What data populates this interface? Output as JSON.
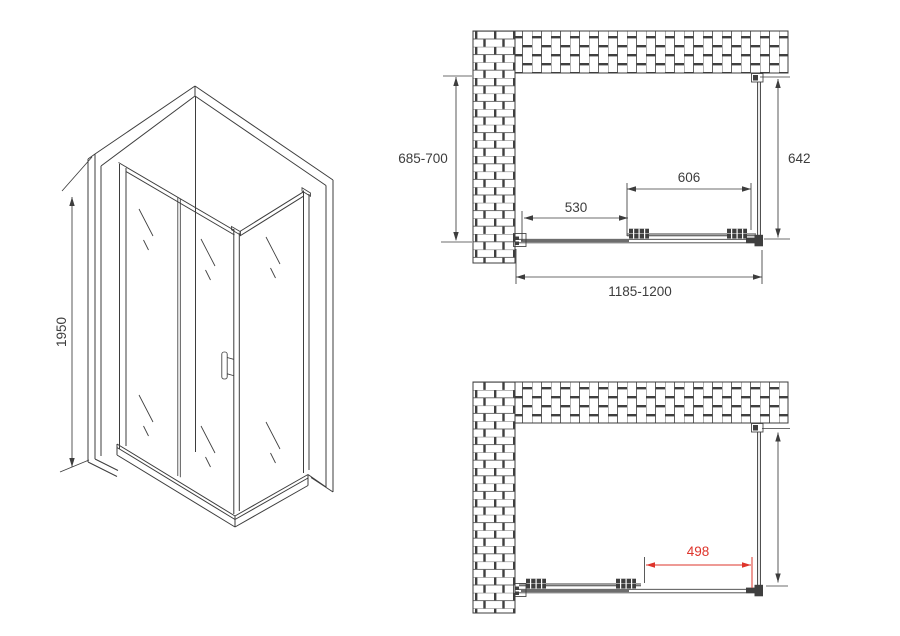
{
  "palette": {
    "line": "#3d3d3d",
    "accent_red": "#de342b",
    "background": "#ffffff"
  },
  "iso_view": {
    "height_dim": "1950"
  },
  "plan_closed": {
    "wall_depth_dim": "685-700",
    "panel_depth_dim": "642",
    "door_width_dim": "606",
    "fixed_width_dim": "530",
    "overall_width_dim": "1185-1200"
  },
  "plan_open": {
    "opening_width_dim": "498"
  }
}
